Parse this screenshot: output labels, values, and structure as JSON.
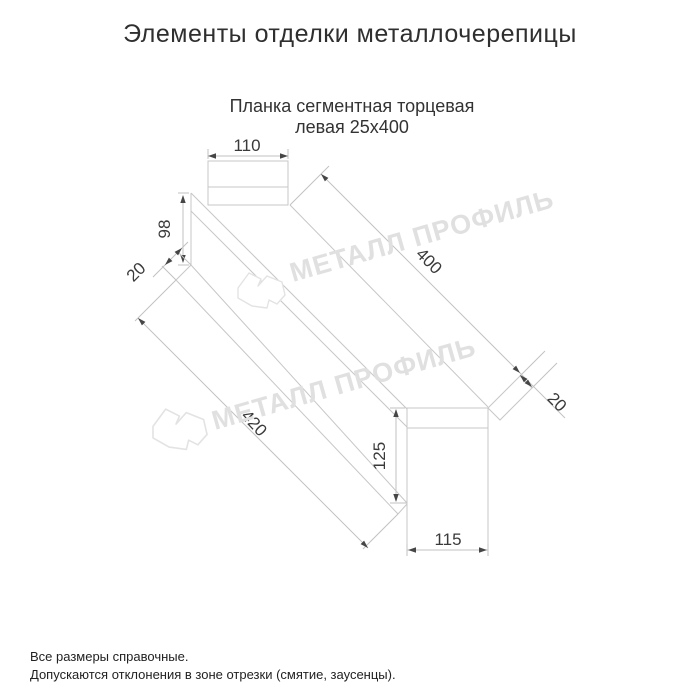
{
  "title": "Элементы отделки металлочерепицы",
  "subtitle": {
    "line1": "Планка сегментная торцевая",
    "line2": "левая 25х400"
  },
  "drawing": {
    "type": "technical-dimension-drawing",
    "part_name": "Планка сегментная торцевая левая 25х400",
    "dimensions": {
      "top_flange_width": "110",
      "left_end_height": "98",
      "left_fold": "20",
      "top_edge_length": "400",
      "bottom_edge_length": "420",
      "right_fold": "20",
      "right_end_height": "125",
      "right_end_width": "115"
    }
  },
  "watermark": {
    "brand": "МЕТАЛЛ ПРОФИЛЬ"
  },
  "footer": {
    "line1": "Все размеры справочные.",
    "line2": "Допускаются отклонения в зоне отрезки (смятие, заусенцы)."
  },
  "colors": {
    "geometry_line": "#c7c7c7",
    "dimension_text": "#3a3a3a",
    "heading_text": "#2f2f2f",
    "watermark": "#e0e0e0"
  }
}
